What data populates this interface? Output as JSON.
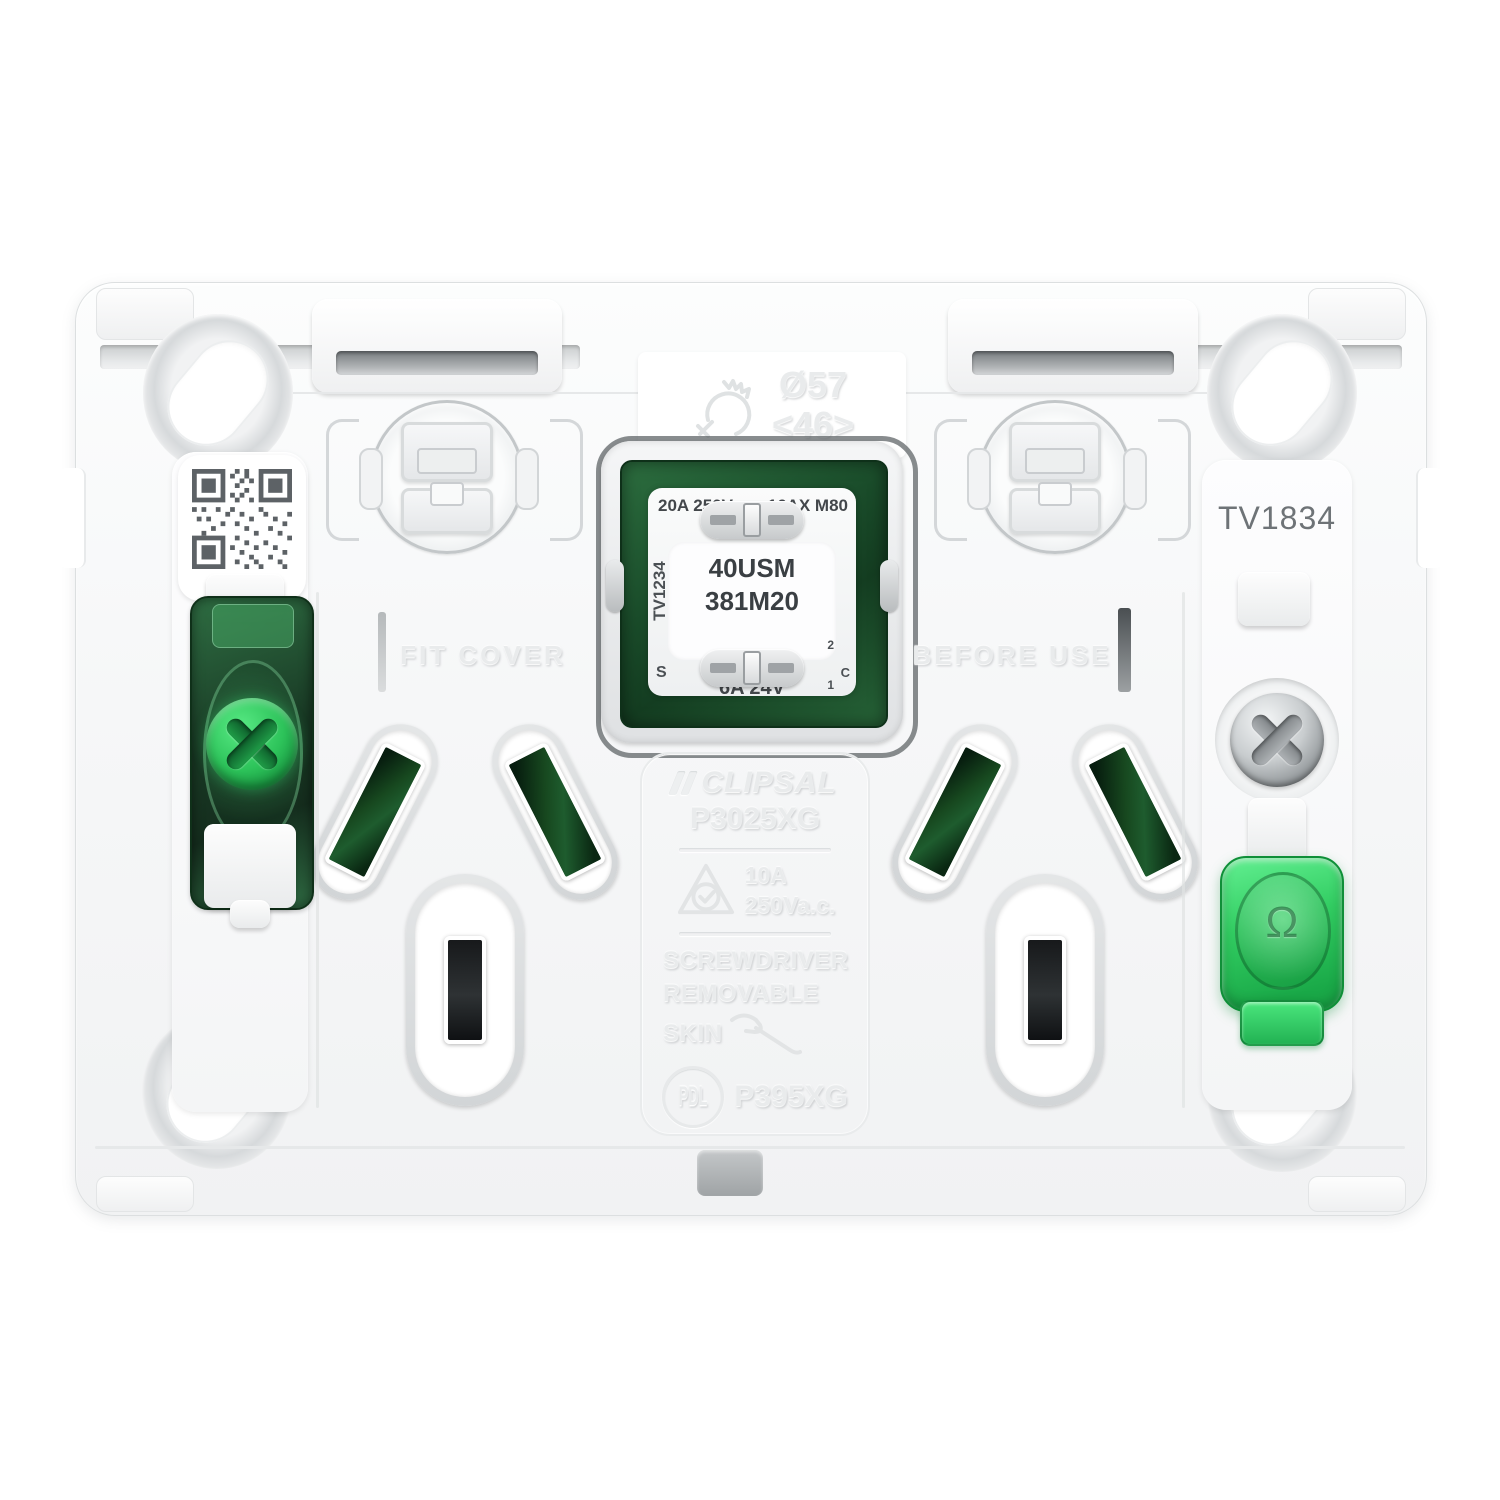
{
  "product": {
    "drill_marking": {
      "diameter": "Ø57",
      "depth_code": "<46>"
    },
    "plate_labels": {
      "fit_cover": "FIT COVER",
      "before_use": "BEFORE USE",
      "tv_code": "TV1834"
    },
    "center_module": {
      "rating_top_left": "20A 250V",
      "rating_top_right": "16AX M80",
      "model_line1": "40USM",
      "model_line2": "381M20",
      "side_code": "TV1234",
      "rating_bottom": "6A 24V",
      "terminal_s": "S",
      "terminal_c": "C",
      "terminal_2": "2",
      "terminal_1": "1"
    },
    "branding_panel": {
      "brand": "CLIPSAL",
      "grid_code": "P3025XG",
      "rating_current": "10A",
      "rating_voltage": "250Va.c.",
      "removal_line1": "SCREWDRIVER",
      "removal_line2": "REMOVABLE",
      "removal_line3": "SKIN",
      "pdl_logo": "PDL",
      "skin_code": "P395XG"
    },
    "rocker_symbol": "Ω",
    "colors": {
      "dark_green": "#1c4f2d",
      "bright_green": "#34d364",
      "plate_white": "#f7f8f9",
      "module_text": "#43474b"
    }
  }
}
